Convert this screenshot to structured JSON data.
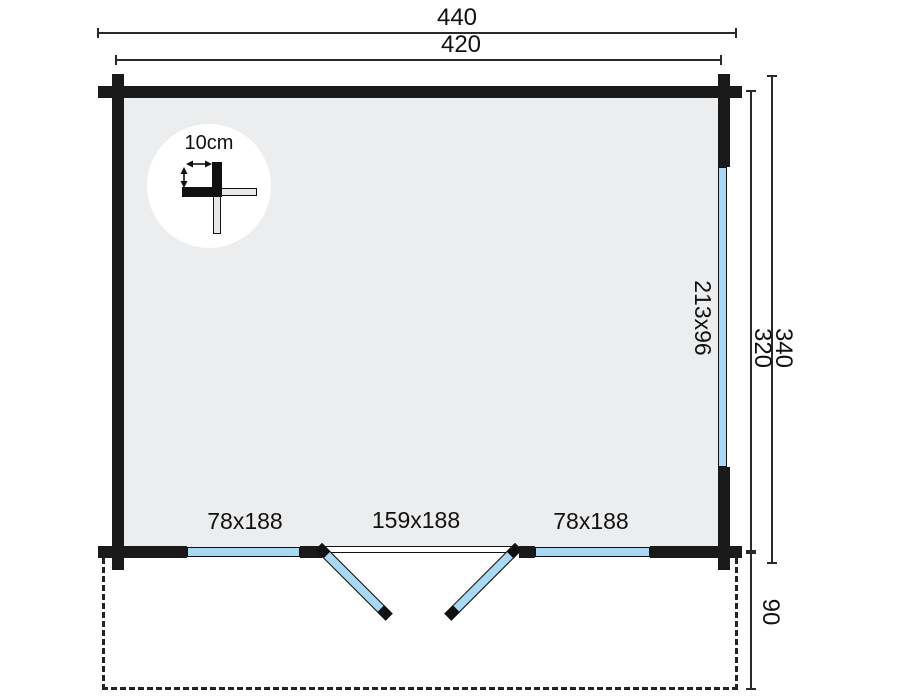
{
  "dimensions": {
    "top_outer": "440",
    "top_inner": "420",
    "right_outer": "340",
    "right_inner": "320",
    "terrace_depth": "90"
  },
  "openings": {
    "side_window": "213x96",
    "bottom_left_window": "78x188",
    "double_door": "159x188",
    "bottom_right_window": "78x188"
  },
  "detail": {
    "wall_thickness": "10cm"
  },
  "colors": {
    "wall": "#1A1A1A",
    "glass": "#A9D8F4",
    "floor": "#ECEDEE",
    "line": "#2A2A2A",
    "text": "#111111"
  }
}
